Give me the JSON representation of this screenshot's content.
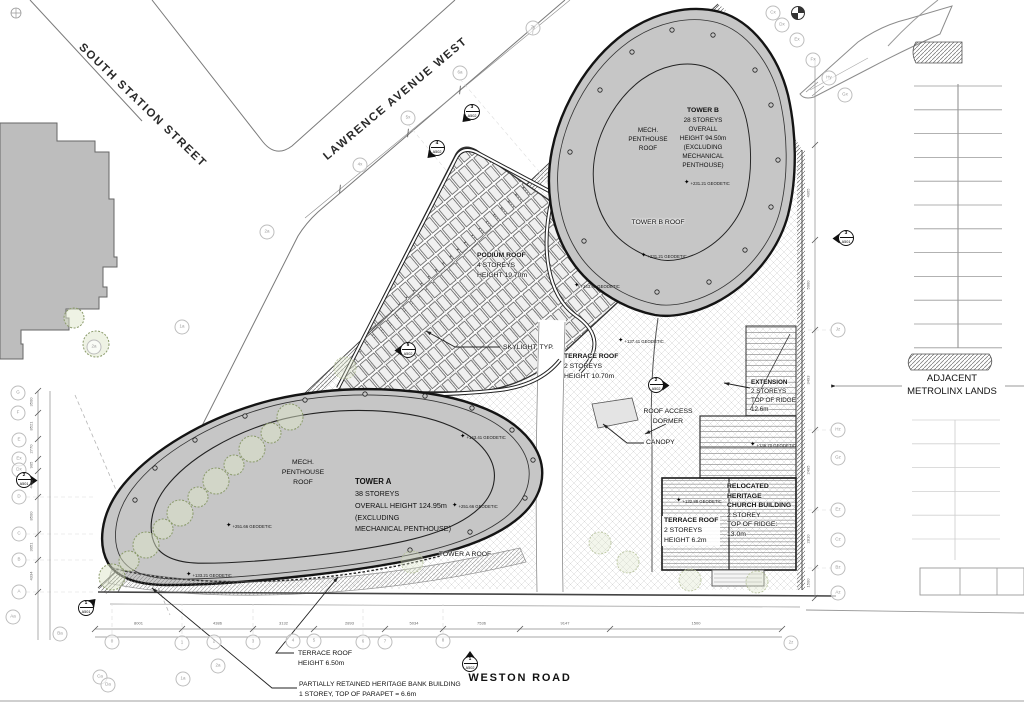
{
  "drawing": {
    "streets": {
      "south_station": "SOUTH STATION STREET",
      "lawrence": "LAWRENCE AVENUE WEST",
      "weston": "WESTON ROAD",
      "adjacent_line1": "ADJACENT",
      "adjacent_line2": "METROLINX LANDS"
    },
    "tower_b": {
      "title": "TOWER B",
      "lines": [
        "28 STOREYS",
        "OVERALL",
        "HEIGHT 94.50m",
        "(EXCLUDING",
        "MECHANICAL",
        "PENTHOUSE)"
      ],
      "roof": "TOWER B ROOF",
      "mech": [
        "MECH.",
        "PENTHOUSE",
        "ROOF"
      ]
    },
    "tower_a": {
      "title": "TOWER A",
      "lines": [
        "38 STOREYS",
        "OVERALL HEIGHT 124.95m",
        "(EXCLUDING",
        "MECHANICAL PENTHOUSE)"
      ],
      "roof": "TOWER A ROOF",
      "mech": [
        "MECH.",
        "PENTHOUSE",
        "ROOF"
      ]
    },
    "podium": {
      "title": "PODIUM ROOF",
      "lines": [
        "4 STOREYS",
        "HEIGHT 19.70m"
      ]
    },
    "terrace_center": {
      "title": "TERRACE ROOF",
      "lines": [
        "2 STOREYS",
        "HEIGHT 10.70m"
      ]
    },
    "terrace_church": {
      "title": "TERRACE ROOF",
      "lines": [
        "2 STOREYS",
        "HEIGHT 6.2m"
      ]
    },
    "terrace_south": {
      "lines": [
        "TERRACE ROOF",
        "HEIGHT 6.50m"
      ]
    },
    "extension": {
      "title": "EXTENSION",
      "lines": [
        "2 STOREYS",
        "TOP OF RIDGE",
        "12.6m"
      ]
    },
    "church": {
      "title_lines": [
        "RELOCATED",
        "HERITAGE",
        "CHURCH BUILDING"
      ],
      "lines": [
        "2 STOREY",
        "TOP OF RIDGE:",
        "13.0m"
      ]
    },
    "bank": {
      "lines": [
        "PARTIALLY RETAINED HERITAGE BANK BUILDING",
        "1 STOREY, TOP OF PARAPET = 6.6m"
      ]
    },
    "callouts": {
      "skylight": "SKYLIGHT, TYP.",
      "dormer_line1": "ROOF ACCESS",
      "dormer_line2": "DORMER",
      "canopy": "CANOPY"
    },
    "geodetic": [
      {
        "t": "+231.21 GEODETIC",
        "x": 684,
        "y": 183
      },
      {
        "t": "+231.21 GEODETIC",
        "x": 641,
        "y": 256
      },
      {
        "t": "+143.41 GEODETIC",
        "x": 574,
        "y": 286
      },
      {
        "t": "+137.41 GEODETIC",
        "x": 618,
        "y": 341
      },
      {
        "t": "+143.41 GEODETIC",
        "x": 460,
        "y": 437
      },
      {
        "t": "+251.66 GEODETIC",
        "x": 452,
        "y": 506
      },
      {
        "t": "+251.66 GEODETIC",
        "x": 226,
        "y": 526
      },
      {
        "t": "+133.21 GEODETIC",
        "x": 186,
        "y": 575
      },
      {
        "t": "+136.70 GEODETIC",
        "x": 750,
        "y": 445
      },
      {
        "t": "+132.88 GEODETIC",
        "x": 676,
        "y": 501
      }
    ],
    "bubbles": [
      {
        "l": "7y",
        "x": 533,
        "y": 28
      },
      {
        "l": "6a",
        "x": 460,
        "y": 73
      },
      {
        "l": "5x",
        "x": 408,
        "y": 118
      },
      {
        "l": "4x",
        "x": 360,
        "y": 165
      },
      {
        "l": "2a",
        "x": 267,
        "y": 232
      },
      {
        "l": "Cx",
        "x": 773,
        "y": 13
      },
      {
        "l": "Dx",
        "x": 782,
        "y": 25
      },
      {
        "l": "Ex",
        "x": 797,
        "y": 40
      },
      {
        "l": "Fx",
        "x": 813,
        "y": 60
      },
      {
        "l": "Hy",
        "x": 829,
        "y": 78
      },
      {
        "l": "Gx",
        "x": 845,
        "y": 95
      },
      {
        "l": "Jz",
        "x": 838,
        "y": 330
      },
      {
        "l": "Hz",
        "x": 838,
        "y": 430
      },
      {
        "l": "Gz",
        "x": 838,
        "y": 458
      },
      {
        "l": "Ez",
        "x": 838,
        "y": 510
      },
      {
        "l": "Cz",
        "x": 838,
        "y": 540
      },
      {
        "l": "Bz",
        "x": 838,
        "y": 568
      },
      {
        "l": "Az",
        "x": 838,
        "y": 593
      },
      {
        "l": "2z",
        "x": 791,
        "y": 643
      },
      {
        "l": "G",
        "x": 18,
        "y": 393
      },
      {
        "l": "F",
        "x": 18,
        "y": 413
      },
      {
        "l": "E",
        "x": 19,
        "y": 440
      },
      {
        "l": "Ex",
        "x": 19,
        "y": 459
      },
      {
        "l": "Dx",
        "x": 19,
        "y": 470
      },
      {
        "l": "D",
        "x": 19,
        "y": 497
      },
      {
        "l": "C",
        "x": 19,
        "y": 534
      },
      {
        "l": "B",
        "x": 19,
        "y": 560
      },
      {
        "l": "A",
        "x": 19,
        "y": 592
      },
      {
        "l": "Aa",
        "x": 13,
        "y": 617
      },
      {
        "l": "Ba",
        "x": 60,
        "y": 634
      },
      {
        "l": "0",
        "x": 112,
        "y": 642
      },
      {
        "l": "1",
        "x": 182,
        "y": 643
      },
      {
        "l": "2",
        "x": 214,
        "y": 642
      },
      {
        "l": "3",
        "x": 253,
        "y": 642
      },
      {
        "l": "4",
        "x": 293,
        "y": 641
      },
      {
        "l": "5",
        "x": 314,
        "y": 641
      },
      {
        "l": "6",
        "x": 363,
        "y": 642
      },
      {
        "l": "7",
        "x": 385,
        "y": 642
      },
      {
        "l": "8",
        "x": 443,
        "y": 641
      },
      {
        "l": "Ca",
        "x": 100,
        "y": 677
      },
      {
        "l": "Da",
        "x": 108,
        "y": 685
      },
      {
        "l": "1a",
        "x": 183,
        "y": 679
      },
      {
        "l": "2a",
        "x": 218,
        "y": 666
      },
      {
        "l": "1a",
        "x": 182,
        "y": 327
      },
      {
        "l": "2a",
        "x": 94,
        "y": 347
      }
    ],
    "sections": [
      {
        "n": "3",
        "s": "A502",
        "x": 472,
        "y": 112,
        "rot": 225
      },
      {
        "n": "4",
        "s": "A502",
        "x": 437,
        "y": 148,
        "rot": 225
      },
      {
        "n": "5",
        "s": "A502",
        "x": 408,
        "y": 350,
        "rot": 270
      },
      {
        "n": "2",
        "s": "A502",
        "x": 656,
        "y": 385,
        "rot": 90
      },
      {
        "n": "2",
        "s": "A501",
        "x": 24,
        "y": 480,
        "rot": 90
      },
      {
        "n": "1",
        "s": "A501",
        "x": 86,
        "y": 608,
        "rot": 45
      },
      {
        "n": "1",
        "s": "A502",
        "x": 470,
        "y": 664,
        "rot": 0
      },
      {
        "n": "3",
        "s": "A501",
        "x": 846,
        "y": 238,
        "rot": 270
      }
    ],
    "dims": {
      "bottom": [
        "8001",
        "4386",
        "3132",
        "2893",
        "5034",
        "7536",
        "9147",
        "1500"
      ],
      "left": [
        "3500",
        "8521",
        "2770",
        "905",
        "4455",
        "8500",
        "3051",
        "4334"
      ],
      "right": [
        "4065",
        "5000",
        "3493",
        "2495",
        "2810",
        "1500"
      ]
    },
    "colors": {
      "roof_fill": "#c6c6c6",
      "context_fill": "#bdbdbd",
      "outline_dark": "#141414",
      "hatch_light": "#d2d2d2",
      "tree_stroke": "#8a9a6a",
      "tree_fill": "#dde5c9"
    }
  }
}
